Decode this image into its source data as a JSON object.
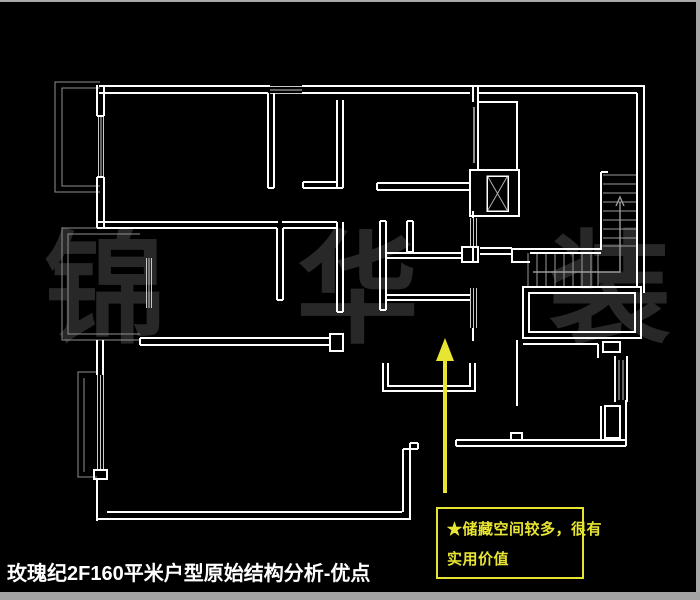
{
  "title": {
    "text": "玫瑰纪2F160平米户型原始结构分析-优点"
  },
  "watermark": {
    "text": "锦 华 装 饰"
  },
  "annotation": {
    "line1": "★储藏空间较多，很有",
    "line2": "实用价值"
  },
  "colors": {
    "background": "#000000",
    "wall_line": "#ffffff",
    "thin_line": "#8f8f8f",
    "glass_line": "#c9c9c9",
    "accent_yellow": "#e8e432",
    "watermark_gray": "#282828",
    "frame_gray": "#a9a9a9",
    "title_text": "#ffffff"
  }
}
